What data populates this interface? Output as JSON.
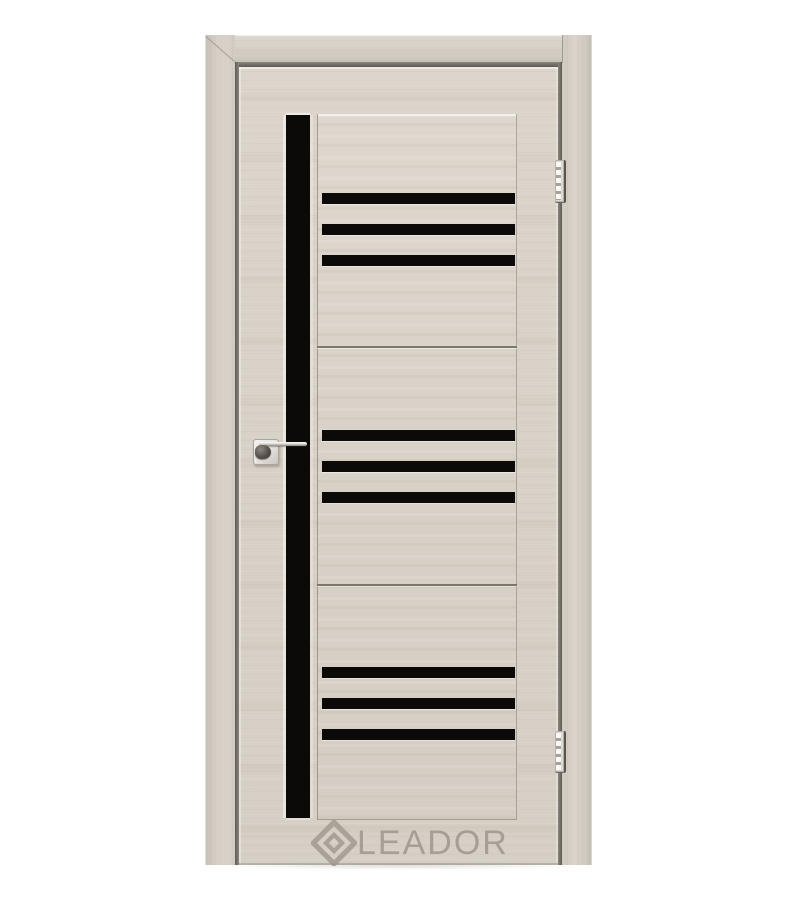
{
  "meta": {
    "type": "product-photo",
    "subject": "Interior door leaf with frame, beige woodgrain finish and black glass inserts"
  },
  "watermark": {
    "brand": "LEADOR",
    "logo": "diamond-logo-icon"
  },
  "door": {
    "finish": "light beige woodgrain",
    "vertical_glass_strips": 1,
    "horizontal_glass_stripes": 9,
    "stripe_groups": 3,
    "stripes_per_group": 3,
    "hinges": 2,
    "hinge_side": "right",
    "handle": "chrome lever on square rosette",
    "handle_side": "left",
    "casing_sides": [
      "left",
      "top",
      "right"
    ]
  },
  "theme": {
    "bg": "#ffffff",
    "casing": "#d2ccc3",
    "casing-dark": "#c3bdb4",
    "leaf": "#d9d2c8",
    "leaf-light": "#e1dbd2",
    "glass": "#0b0a08",
    "gap": "#6e6962",
    "seam": "#7d766b",
    "watermark": "#a19b93",
    "chrome": "#e9e7e3",
    "chrome-dark": "#55504a"
  }
}
